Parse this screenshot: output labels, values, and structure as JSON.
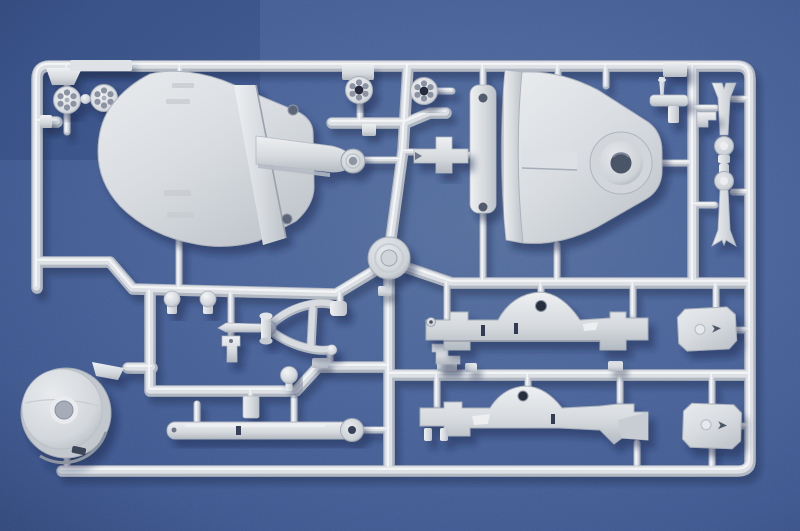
{
  "scene": {
    "description": "Photograph of an unpainted light-gray injection-molded model kit sprue (parts tree) lying on a mottled blue surface",
    "background": "mottled blue fabric-like surface",
    "material": "light gray polystyrene plastic"
  },
  "colors": {
    "background_base": "#49639a",
    "background_dark": "#32497c",
    "background_light": "#566fa6",
    "plastic_light": "#eceef0",
    "plastic_base": "#d5d9dd",
    "plastic_shadow": "#aab0b9",
    "plastic_dark": "#7e8694",
    "hole_dark": "#262c3e",
    "cast_shadow": "#13224a"
  },
  "parts": {
    "scene_label": {
      "label": "model kit sprue photograph"
    },
    "frame": {
      "label": "outer sprue frame runner"
    },
    "runners": {
      "label": "inner runner network"
    },
    "hub": {
      "label": "central sprue injection hub"
    },
    "roadwheels_left": {
      "label": "perforated road wheel pair (left)"
    },
    "roadwheels_center": {
      "label": "perforated road wheel pair (center)"
    },
    "shield_outer": {
      "label": "outer gun shield plate with pivot arm"
    },
    "shield_inner": {
      "label": "inner gun shield with round pivot boss"
    },
    "mount_strip": {
      "label": "mounting strip with two bolt holes"
    },
    "sight_cross": {
      "label": "cross-shaped mount bracket"
    },
    "towbar": {
      "label": "wishbone tow-bar loop"
    },
    "rod": {
      "label": "tapered linkage rod with spindle"
    },
    "dome_pins": {
      "label": "dome-head pins"
    },
    "ball_pin": {
      "label": "ball-head pin"
    },
    "brackets": {
      "label": "small mounting brackets and blocks"
    },
    "recoil_arm": {
      "label": "long slide arm with pivot knuckle"
    },
    "drum": {
      "label": "large wheel drum with center hole"
    },
    "axle_upper": {
      "label": "axle assembly (upper)"
    },
    "axle_lower": {
      "label": "axle assembly (lower) with gusset"
    },
    "plate_upper": {
      "label": "chamfered mounting plate (upper)"
    },
    "plate_lower": {
      "label": "chamfered mounting plate (lower)"
    },
    "trail_legs": {
      "label": "trail leg pair with knuckle joints"
    },
    "pin_cluster": {
      "label": "small pin, bar and bracket cluster"
    },
    "frame_tabs": {
      "label": "flat tabs on frame runner"
    }
  }
}
